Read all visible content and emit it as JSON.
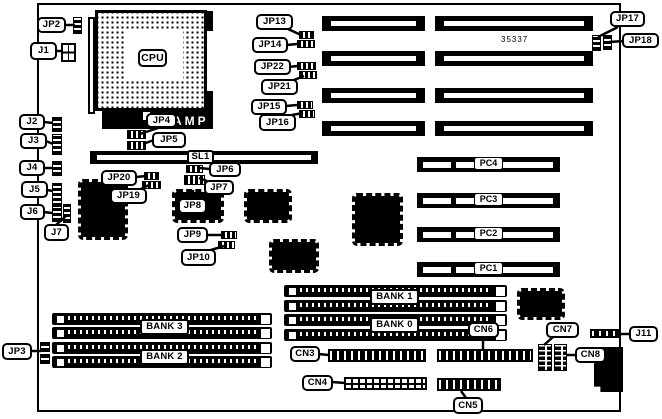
{
  "diagram": {
    "type": "motherboard-layout",
    "part_number": "35337",
    "colors": {
      "ink": "#000000",
      "paper": "#ffffff"
    }
  },
  "labels": {
    "cpu": "CPU",
    "amp": "AMP",
    "part_number": "35337",
    "sl1": "SL1",
    "jp2": "JP2",
    "jp3": "JP3",
    "jp4": "JP4",
    "jp5": "JP5",
    "jp6": "JP6",
    "jp7": "JP7",
    "jp8": "JP8",
    "jp9": "JP9",
    "jp10": "JP10",
    "jp13": "JP13",
    "jp14": "JP14",
    "jp15": "JP15",
    "jp16": "JP16",
    "jp17": "JP17",
    "jp18": "JP18",
    "jp19": "JP19",
    "jp20": "JP20",
    "jp21": "JP21",
    "jp22": "JP22",
    "j1": "J1",
    "j2": "J2",
    "j3": "J3",
    "j4": "J4",
    "j5": "J5",
    "j6": "J6",
    "j7": "J7",
    "j11": "J11",
    "pc1": "PC1",
    "pc2": "PC2",
    "pc3": "PC3",
    "pc4": "PC4",
    "bank0": "BANK 0",
    "bank1": "BANK 1",
    "bank2": "BANK 2",
    "bank3": "BANK 3",
    "cn3": "CN3",
    "cn4": "CN4",
    "cn5": "CN5",
    "cn6": "CN6",
    "cn7": "CN7",
    "cn8": "CN8"
  }
}
